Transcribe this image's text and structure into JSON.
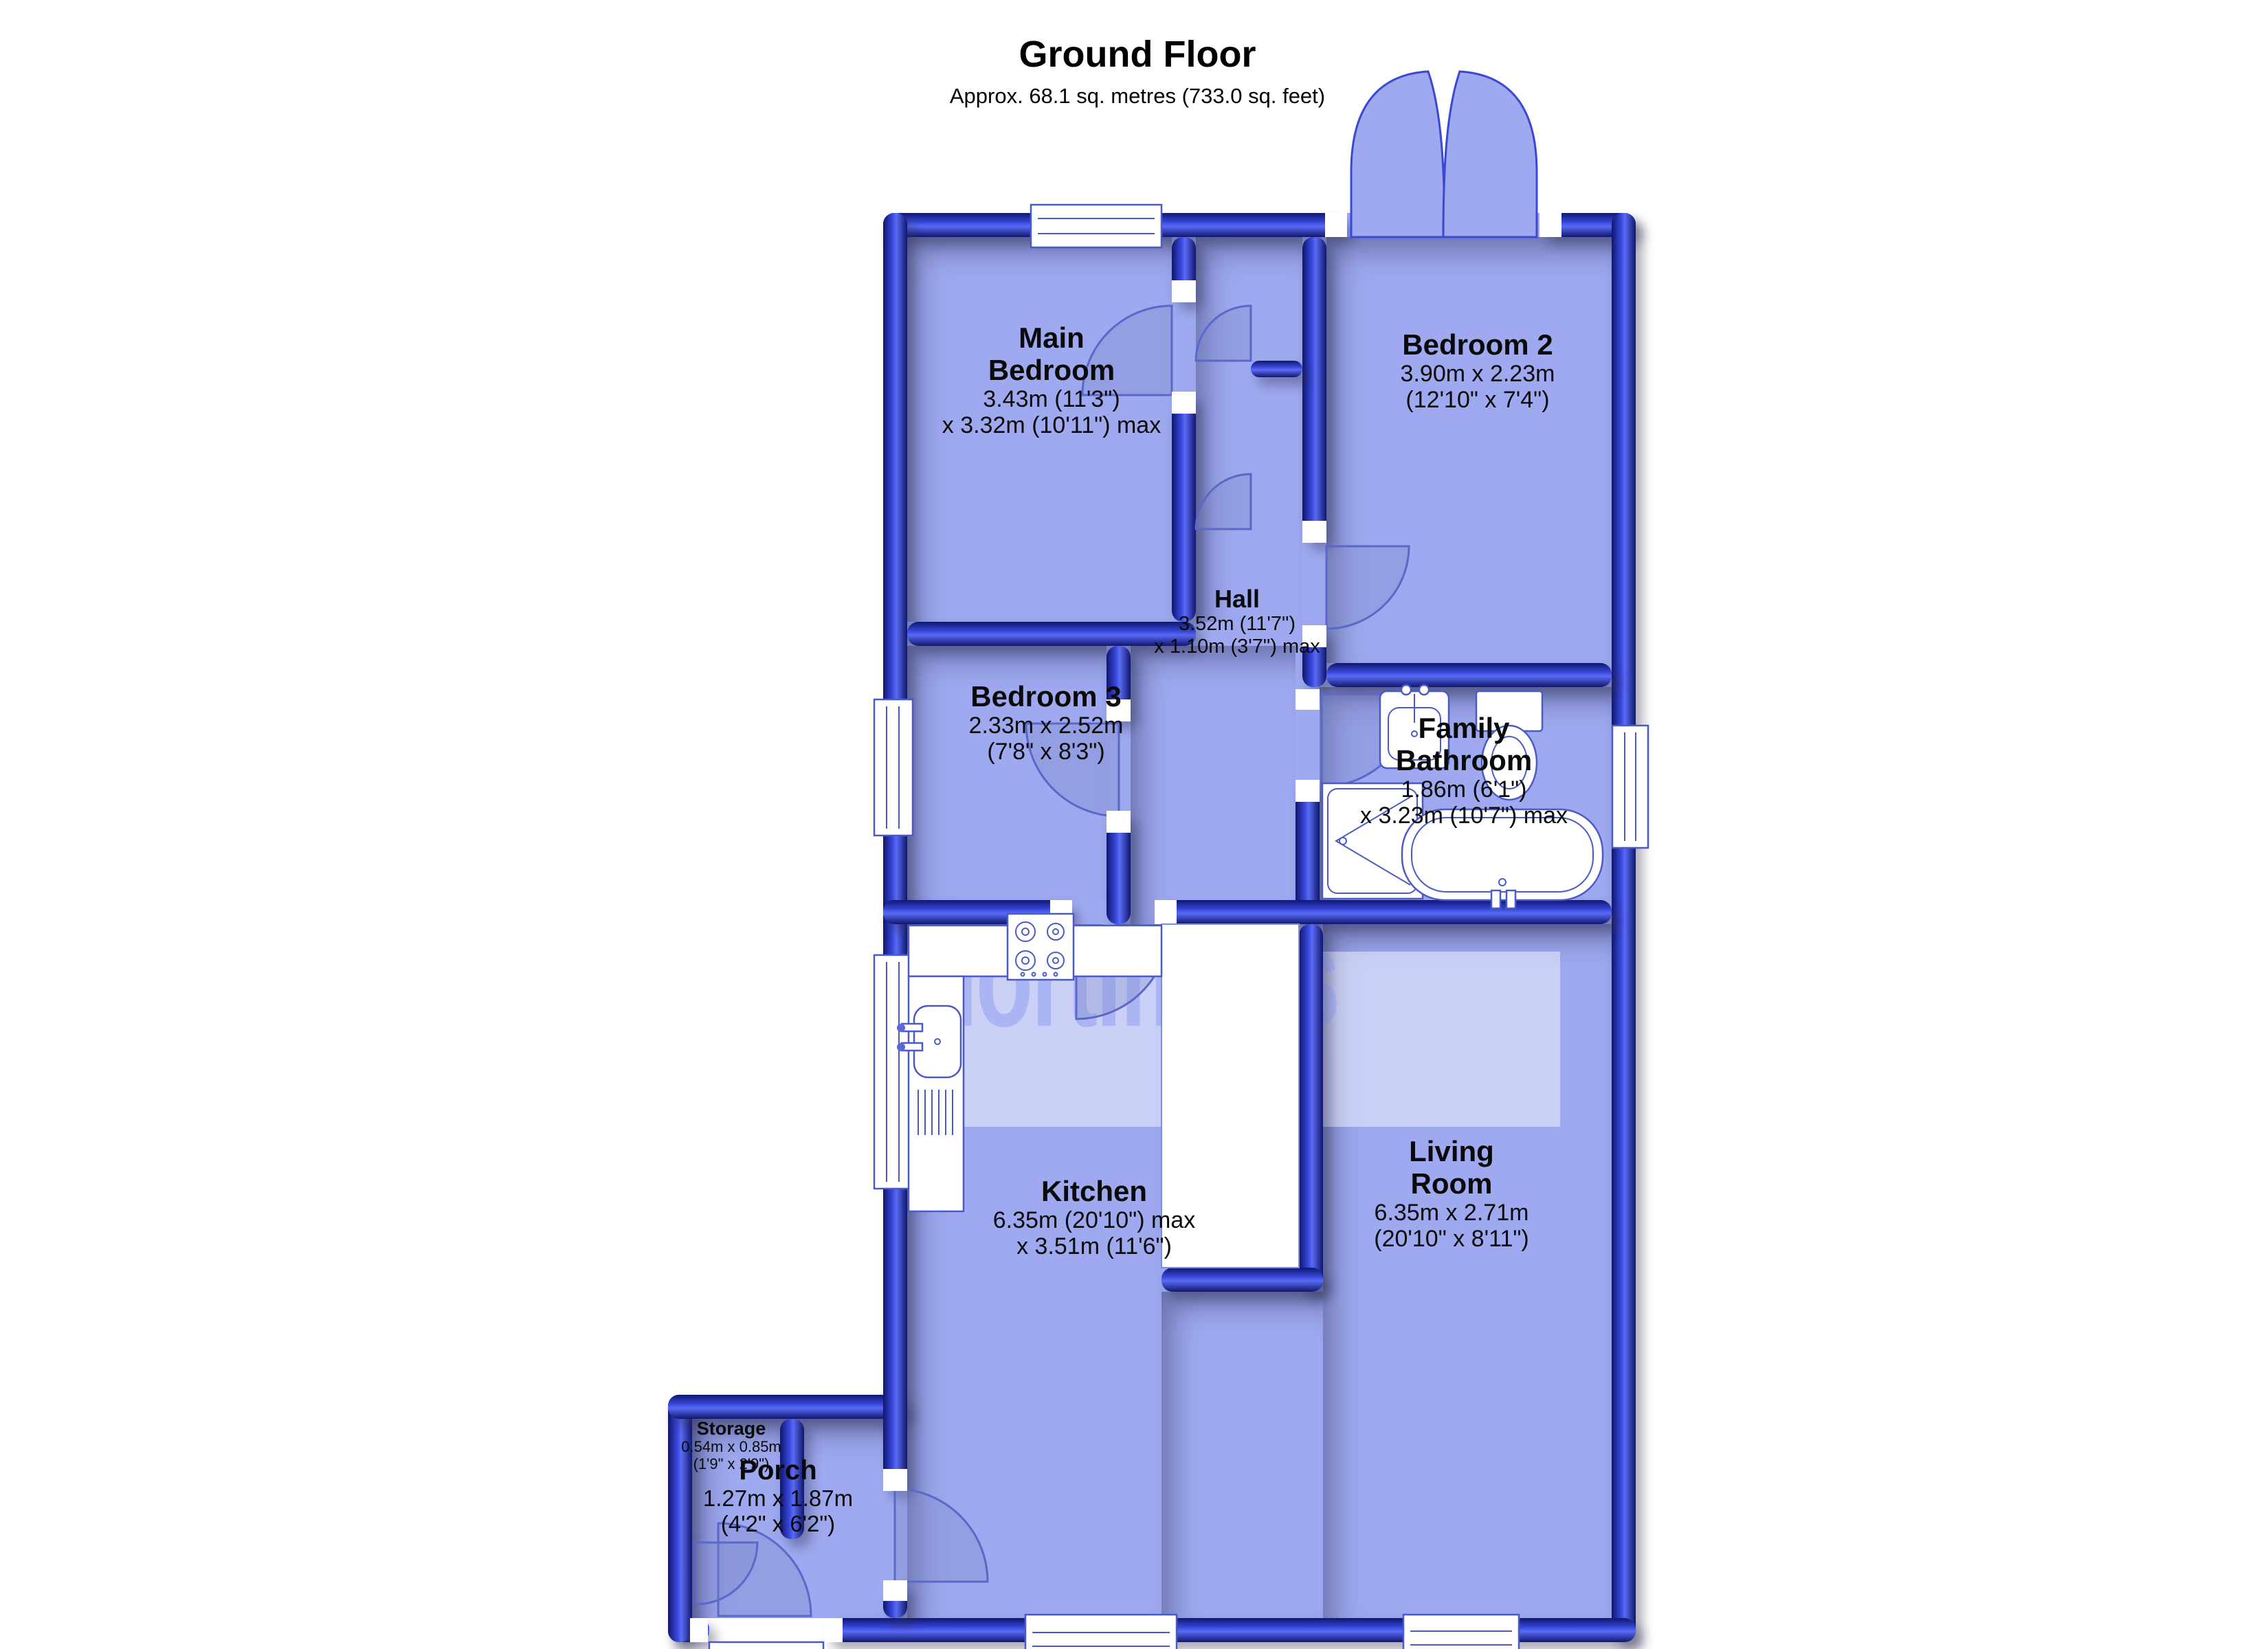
{
  "header": {
    "title": "Ground Floor",
    "subtitle": "Approx. 68.1 sq. metres (733.0 sq. feet)"
  },
  "watermark": "mortimers",
  "palette": {
    "wall_blue": "#3747d8",
    "wall_dark": "#10166e",
    "floor": "#9ea9ef",
    "fixture_line": "#4a5ac8",
    "label_text": "#0a0a0a"
  },
  "rooms": {
    "main_bedroom": {
      "name1": "Main",
      "name2": "Bedroom",
      "dim1": "3.43m (11'3\")",
      "dim2": "x 3.32m (10'11\") max"
    },
    "bedroom2": {
      "name1": "Bedroom 2",
      "name2": "",
      "dim1": "3.90m x 2.23m",
      "dim2": "(12'10\" x 7'4\")"
    },
    "hall": {
      "name1": "Hall",
      "name2": "",
      "dim1": "3.52m (11'7\")",
      "dim2": "x 1.10m (3'7\") max"
    },
    "bedroom3": {
      "name1": "Bedroom 3",
      "name2": "",
      "dim1": "2.33m x 2.52m",
      "dim2": "(7'8\" x 8'3\")"
    },
    "bathroom": {
      "name1": "Family",
      "name2": "Bathroom",
      "dim1": "1.86m (6'1\")",
      "dim2": "x 3.23m (10'7\") max"
    },
    "kitchen": {
      "name1": "Kitchen",
      "name2": "",
      "dim1": "6.35m (20'10\") max",
      "dim2": "x 3.51m (11'6\")"
    },
    "living": {
      "name1": "Living",
      "name2": "Room",
      "dim1": "6.35m x 2.71m",
      "dim2": "(20'10\" x 8'11\")"
    },
    "porch": {
      "name1": "Porch",
      "name2": "",
      "dim1": "1.27m x 1.87m",
      "dim2": "(4'2\" x 6'2\")"
    },
    "storage": {
      "name1": "Storage",
      "name2": "",
      "dim1": "0.54m x 0.85m",
      "dim2": "(1'9\" x 2'9\")"
    }
  }
}
